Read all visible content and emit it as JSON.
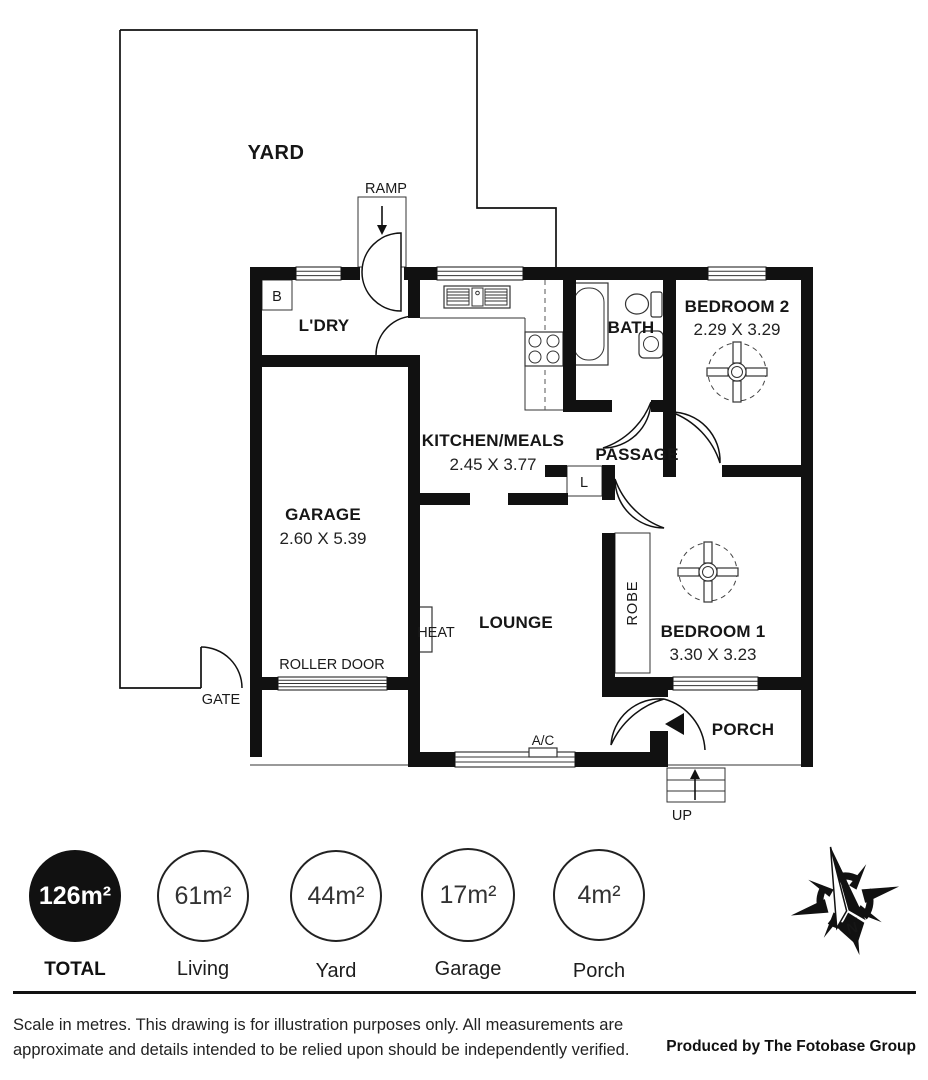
{
  "rooms": {
    "yard": {
      "name": "YARD"
    },
    "ldry": {
      "name": "L'DRY"
    },
    "kitchen": {
      "name": "KITCHEN/MEALS",
      "dims": "2.45 X 3.77"
    },
    "bath": {
      "name": "BATH"
    },
    "bedroom2": {
      "name": "BEDROOM 2",
      "dims": "2.29 X 3.29"
    },
    "passage": {
      "name": "PASSAGE"
    },
    "garage": {
      "name": "GARAGE",
      "dims": "2.60 X 5.39"
    },
    "lounge": {
      "name": "LOUNGE"
    },
    "bedroom1": {
      "name": "BEDROOM 1",
      "dims": "3.30 X 3.23"
    },
    "porch": {
      "name": "PORCH"
    }
  },
  "annotations": {
    "ramp": "RAMP",
    "gate": "GATE",
    "roller_door": "ROLLER DOOR",
    "heat": "HEAT",
    "ac": "A/C",
    "up": "UP",
    "robe": "ROBE",
    "boiler": "B",
    "linen": "L",
    "compass_north": "N"
  },
  "area_summary": [
    {
      "value": "126m²",
      "label": "TOTAL",
      "highlight": true
    },
    {
      "value": "61m²",
      "label": "Living",
      "highlight": false
    },
    {
      "value": "44m²",
      "label": "Yard",
      "highlight": false
    },
    {
      "value": "17m²",
      "label": "Garage",
      "highlight": false
    },
    {
      "value": "4m²",
      "label": "Porch",
      "highlight": false
    }
  ],
  "footer": {
    "disclaimer_line1": "Scale in metres. This drawing is for illustration purposes only. All measurements are",
    "disclaimer_line2": "approximate and details intended to be relied upon should be independently verified.",
    "producer": "Produced by The Fotobase Group"
  },
  "colors": {
    "wall": "#111111",
    "line": "#333333",
    "text": "#161616",
    "background": "#ffffff"
  }
}
